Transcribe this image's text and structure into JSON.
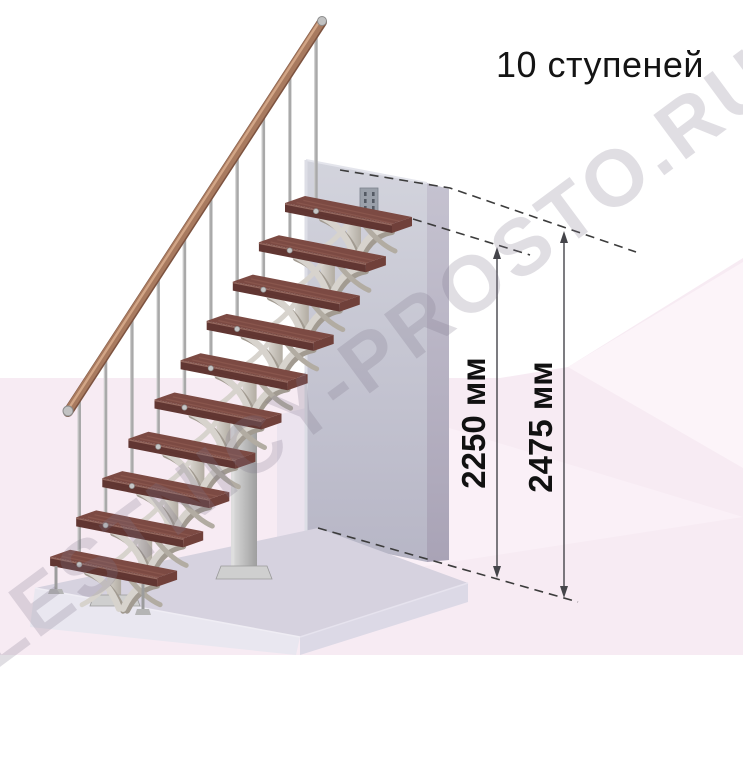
{
  "title": "10 ступеней",
  "watermark": {
    "text": "LESTNICY-PROSTO.RU"
  },
  "dimensions": [
    {
      "label": "2250 мм"
    },
    {
      "label": "2475 мм"
    }
  ],
  "stairs": {
    "step_count": 10
  },
  "colors": {
    "background": "#ffffff",
    "backdrop_pink": "#f7ebf3",
    "backdrop_pink_light": "#fcf4f9",
    "backdrop_wedge": "#faf0f7",
    "backdrop_lavender": "#ebe3ee",
    "floor_top": "#d6d2df",
    "floor_front": "#e9e7f0",
    "floor_side": "#dcd9e6",
    "wall_front_top": "#d3d4dd",
    "wall_front_bottom": "#b7b6c6",
    "wall_side_top": "#c5c2d0",
    "wall_side_bottom": "#a9a3b6",
    "wall_plate": "#9aa0aa",
    "wall_plate_hole": "#545a64",
    "tread_top": "#7c4a43",
    "tread_front": "#613632",
    "tread_side": "#70403a",
    "tread_grain": "#935f54",
    "tread_nosing": "#a3756a",
    "rail_wood": "#a87a5f",
    "rail_highlight": "#d2a586",
    "rail_shadow": "#7d5340",
    "rail_cap": "#c2c2c2",
    "metal_light": "#d7d3cd",
    "metal_mid": "#b2aca2",
    "metal_dark": "#a29b91",
    "baluster": "#a9a9a9",
    "column_body": "#c9c9c9",
    "column_light": "#dedede",
    "column_dark": "#9e9e9e",
    "plate_metal": "#cfcfcf",
    "dash_line": "#3c3c3c",
    "dim_line": "#45454a",
    "text": "#141414"
  }
}
